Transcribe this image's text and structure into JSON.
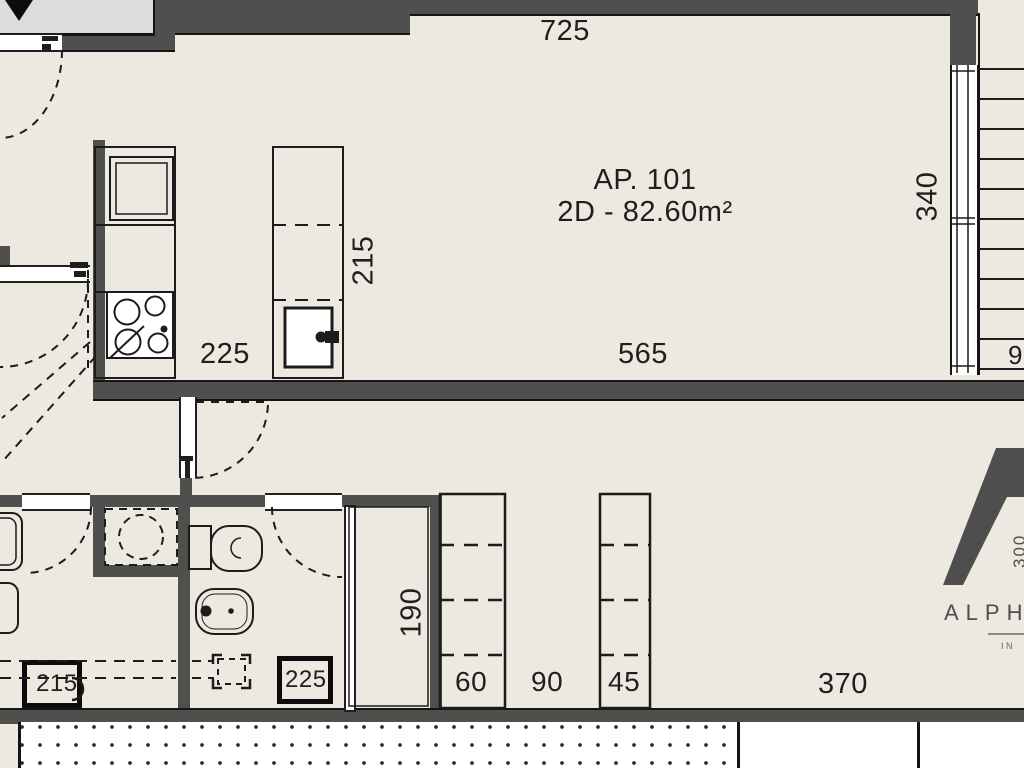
{
  "plan": {
    "apartment_label": "AP. 101",
    "area_label": "2D - 82.60m²"
  },
  "dimensions": {
    "top_width": "725",
    "right_height": "340",
    "island_depth": "215",
    "kitchen_front": "225",
    "living_width": "565",
    "right_cut": "9",
    "closet_width": "190",
    "wardrobe_a": "60",
    "hall_gap": "90",
    "wardrobe_b": "45",
    "bedroom_width": "370",
    "fixture_box_left": "215",
    "fixture_box_wc": "225"
  },
  "logo": {
    "brand": "ALPHA",
    "side_mark": "300",
    "subtitle": "IN"
  },
  "colors": {
    "bg": "#EDE8E0",
    "wall": "#4F4F4D",
    "ink": "#1F1F1F",
    "corridor": "#DCDCDA",
    "logo": "#4E4E4E"
  }
}
